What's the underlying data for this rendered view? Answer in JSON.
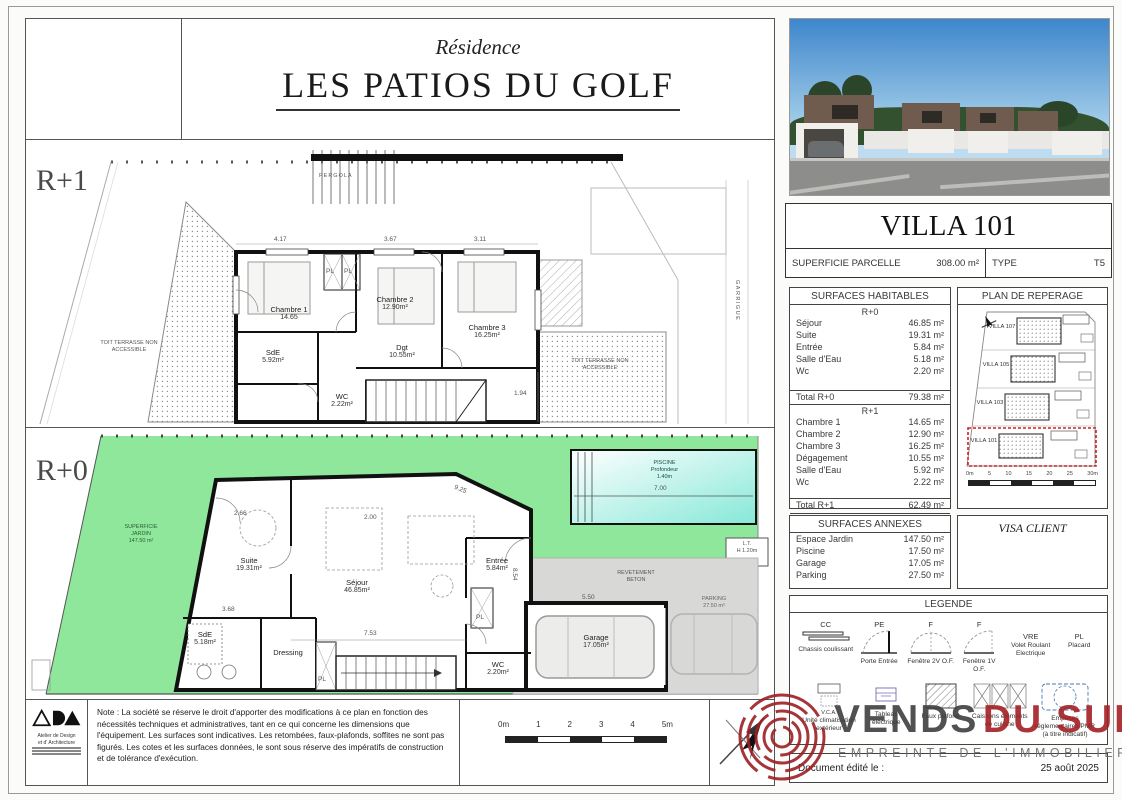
{
  "page": {
    "watermark": "© EtreProprio.com"
  },
  "header": {
    "subtitle": "Résidence",
    "title": "LES PATIOS DU GOLF"
  },
  "r1": {
    "floor": "R+1",
    "pergola": "PERGOLA",
    "terrace_left": "TOIT TERRASSE NON ACCESSIBLE",
    "terrace_right": "TOIT TERRASSE NON ACCESSIBLE",
    "garrigue": "GARRIGUE",
    "pl": "PL",
    "rooms": {
      "ch1": {
        "n": "Chambre 1",
        "a": "14.65"
      },
      "ch2": {
        "n": "Chambre 2",
        "a": "12.90m²"
      },
      "ch3": {
        "n": "Chambre 3",
        "a": "16.25m²"
      },
      "dgt": {
        "n": "Dgt",
        "a": "10.55m²"
      },
      "sde": {
        "n": "SdE",
        "a": "5.92m²"
      },
      "wc": {
        "n": "WC",
        "a": "2.22m²"
      }
    },
    "dims": [
      "4.17",
      "3.67",
      "3.11",
      "1.94"
    ]
  },
  "r0": {
    "floor": "R+0",
    "jardin": {
      "l1": "SUPERFICIE",
      "l2": "JARDIN",
      "l3": "147.50 m²"
    },
    "piscine": {
      "l1": "PISCINE",
      "l2": "Profondeur",
      "l3": "1.40m",
      "dim": "7.00"
    },
    "lt": {
      "l1": "L.T.",
      "l2": "H 1.20m"
    },
    "pl": "PL",
    "rooms": {
      "suite": {
        "n": "Suite",
        "a": "19.31m²"
      },
      "sejour": {
        "n": "Séjour",
        "a": "46.85m²"
      },
      "entree": {
        "n": "Entrée",
        "a": "5.84m²"
      },
      "sde": {
        "n": "SdE",
        "a": "5.18m²"
      },
      "dressing": {
        "n": "Dressing",
        "a": ""
      },
      "wc": {
        "n": "WC",
        "a": "2.20m²"
      },
      "garage": {
        "n": "Garage",
        "a": "17.05m²"
      }
    },
    "revetement": {
      "l1": "REVETEMENT",
      "l2": "BETON"
    },
    "parking": {
      "l1": "PARKING",
      "l2": "27.50 m²"
    },
    "dims": [
      "2.66",
      "2.00",
      "9.25",
      "3.68",
      "7.53",
      "8.54",
      "5.50"
    ]
  },
  "panel": {
    "villa_title": "VILLA 101",
    "parcel_label": "SUPERFICIE PARCELLE",
    "parcel_value": "308.00 m²",
    "type_label": "TYPE",
    "type_value": "T5",
    "habitables": {
      "title": "SURFACES HABITABLES",
      "r0_header": "R+0",
      "r0_rows": [
        {
          "label": "Séjour",
          "value": "46.85 m²"
        },
        {
          "label": "Suite",
          "value": "19.31 m²"
        },
        {
          "label": "Entrée",
          "value": "5.84 m²"
        },
        {
          "label": "Salle d'Eau",
          "value": "5.18 m²"
        },
        {
          "label": "Wc",
          "value": "2.20 m²"
        }
      ],
      "r0_total": {
        "label": "Total R+0",
        "value": "79.38 m²"
      },
      "r1_header": "R+1",
      "r1_rows": [
        {
          "label": "Chambre 1",
          "value": "14.65 m²"
        },
        {
          "label": "Chambre 2",
          "value": "12.90 m²"
        },
        {
          "label": "Chambre 3",
          "value": "16.25 m²"
        },
        {
          "label": "Dégagement",
          "value": "10.55 m²"
        },
        {
          "label": "Salle d'Eau",
          "value": "5.92 m²"
        },
        {
          "label": "Wc",
          "value": "2.22 m²"
        }
      ],
      "r1_total": {
        "label": "Total R+1",
        "value": "62.49 m²"
      },
      "total": {
        "label": "TOTAL",
        "value": "141.87 m²"
      }
    },
    "reperage": {
      "title": "PLAN DE REPERAGE",
      "villas": [
        "VILLA 107",
        "VILLA 105",
        "VILLA 103",
        "VILLA 101"
      ],
      "scale": [
        "0m",
        "5",
        "10",
        "15",
        "20",
        "25",
        "30m"
      ]
    },
    "annexes": {
      "title": "SURFACES ANNEXES",
      "rows": [
        {
          "label": "Espace Jardin",
          "value": "147.50 m²"
        },
        {
          "label": "Piscine",
          "value": "17.50 m²"
        },
        {
          "label": "Garage",
          "value": "17.05 m²"
        },
        {
          "label": "Parking",
          "value": "27.50 m²"
        }
      ]
    },
    "visa": "VISA CLIENT",
    "legende": {
      "title": "LEGENDE",
      "row1": [
        {
          "code": "CC",
          "label": "Chassis coulissant"
        },
        {
          "code": "PE",
          "label": "Porte Entrée"
        },
        {
          "code": "F",
          "label": "Fenêtre 2V O.F."
        },
        {
          "code": "F",
          "label": "Fenêtre 1V O.F."
        },
        {
          "code": "VRE",
          "label": "Volet Roulant Electrique"
        },
        {
          "code": "PL",
          "label": "Placard"
        }
      ],
      "row2": [
        {
          "code": "V.C.A.",
          "label": "Unité climatisation extérieur"
        },
        {
          "code": "",
          "label": "Tableau électrique"
        },
        {
          "code": "",
          "label": "Faux plafond"
        },
        {
          "code": "",
          "label": "Caissons éléments de cuisine"
        },
        {
          "code": "",
          "label": "Emprises réglementaires PMR (à titre indicatif)"
        }
      ]
    },
    "doc": {
      "label": "Document édité le :",
      "date": "25 août 2025"
    }
  },
  "footer": {
    "ada1": "Atelier de Design",
    "ada2": "et d' Architecture",
    "note": "Note : La société se réserve le droit d'apporter des modifications à ce plan en fonction des nécessités techniques et administratives, tant en ce qui concerne les dimensions que l'équipement. Les surfaces sont indicatives. Les retombées, faux-plafonds, soffites ne sont pas figurés. Les cotes et les surfaces données, le sont sous réserve des impératifs de construction et de tolérance d'exécution.",
    "scale": [
      "0m",
      "1",
      "2",
      "3",
      "4",
      "5m"
    ]
  },
  "logo_wm": {
    "p1": "VENDS",
    "p2": "DU SUD",
    "tagline": "EMPREINTE DE L'IMMOBILIER"
  },
  "colors": {
    "garden": "#8ee79b",
    "pool": "#86e8d8",
    "concrete": "#d8d8d6",
    "highlight_red": "#cc2222",
    "logo_red": "#a32024"
  }
}
